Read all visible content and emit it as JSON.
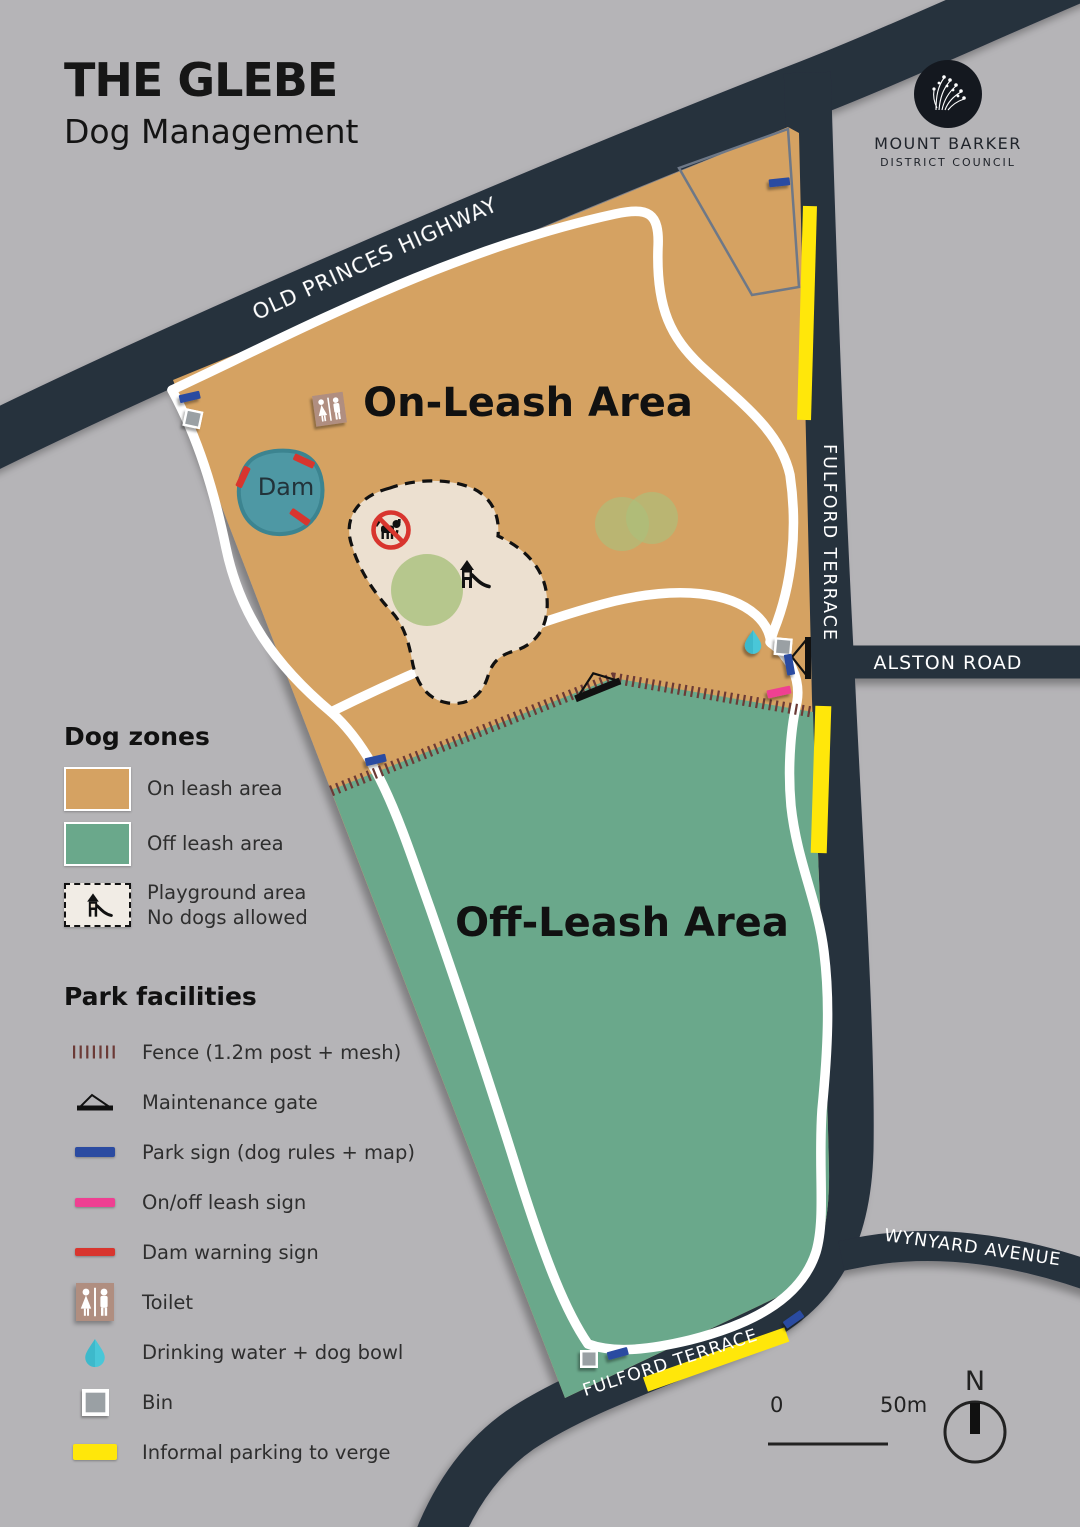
{
  "header": {
    "title": "THE GLEBE",
    "subtitle": "Dog Management"
  },
  "logo": {
    "name": "MOUNT BARKER",
    "subname": "DISTRICT COUNCIL"
  },
  "map": {
    "labels": {
      "on_leash": "On-Leash Area",
      "off_leash": "Off-Leash Area",
      "dam": "Dam"
    },
    "roads": {
      "old_princes": "OLD PRINCES HIGHWAY",
      "fulford_east": "FULFORD TERRACE",
      "alston": "ALSTON ROAD",
      "wynyard": "WYNYARD AVENUE",
      "fulford_south": "FULFORD TERRACE"
    },
    "scale": {
      "start": "0",
      "end": "50m"
    },
    "north_label": "N"
  },
  "legend": {
    "dog_zones": {
      "heading": "Dog zones",
      "items": [
        {
          "label": "On leash area",
          "swatch": "#d5a262"
        },
        {
          "label": "Off leash area",
          "swatch": "#6aa88b"
        },
        {
          "label": "Playground area",
          "label2": "No dogs allowed"
        }
      ]
    },
    "park_facilities": {
      "heading": "Park facilities",
      "items": [
        {
          "label": "Fence (1.2m post + mesh)",
          "icon": "fence-icon"
        },
        {
          "label": "Maintenance gate",
          "icon": "gate-icon"
        },
        {
          "label": "Park sign (dog rules + map)",
          "icon": "park-sign-icon"
        },
        {
          "label": "On/off leash sign",
          "icon": "leash-sign-icon"
        },
        {
          "label": "Dam warning sign",
          "icon": "dam-sign-icon"
        },
        {
          "label": "Toilet",
          "icon": "toilet-icon"
        },
        {
          "label": "Drinking water + dog bowl",
          "icon": "water-icon"
        },
        {
          "label": "Bin",
          "icon": "bin-icon"
        },
        {
          "label": "Informal parking to verge",
          "icon": "parking-icon"
        }
      ]
    }
  },
  "colors": {
    "background": "#b5b4b7",
    "road": "#27303e",
    "road_text": "#ffffff",
    "on_leash": "#d5a262",
    "off_leash": "#6aa88b",
    "playground": "#ece0d0",
    "dam": "#4e98a4",
    "path": "#ffffff",
    "parking": "#ffe70a",
    "park_sign": "#2b4ba1",
    "leash_sign": "#ef3f92",
    "dam_sign": "#d8352e",
    "fence": "#6b3a36",
    "tree": "#a9c07c",
    "toilet": "#b08e80",
    "water": "#49c7d8"
  }
}
